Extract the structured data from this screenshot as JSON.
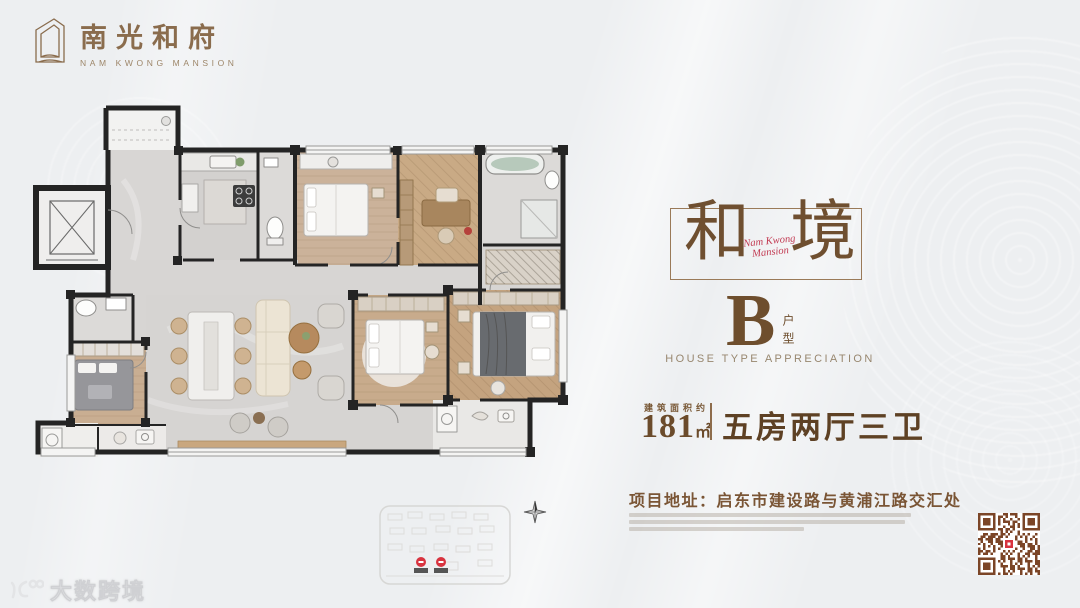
{
  "brand": {
    "name_cn": "南光和府",
    "name_en": "NAM KWONG MANSION"
  },
  "hero": {
    "frame_char_left": "和",
    "frame_char_right": "境",
    "script_line1": "Nam Kwong",
    "script_line2": "Mansion",
    "type_letter": "B",
    "type_label": "户型",
    "type_subtitle": "HOUSE TYPE APPRECIATION",
    "area_label": "建筑面积约",
    "area_value": "181",
    "area_unit": "㎡",
    "layout_text": "五房两厅三卫",
    "address_label": "项目地址：",
    "address_value": "启东市建设路与黄浦江路交汇处"
  },
  "watermark": {
    "text": "大数跨境"
  },
  "floorplan": {
    "type": "residential-floor-plan",
    "rooms": [
      "elevator",
      "entry-foyer",
      "kitchen",
      "bathroom-1",
      "bedroom-2",
      "study",
      "bathroom-2",
      "bathroom-3",
      "bedroom-3",
      "living-dining",
      "bedroom-4",
      "master-bedroom",
      "balcony-left",
      "balcony-right"
    ]
  },
  "colors": {
    "background": "#edeff1",
    "accent_brown": "#7a5a38",
    "deep_brown": "#6b4b2b",
    "script_red": "#c23a52",
    "wall_black": "#242424",
    "qr_brown": "#7b4527",
    "pin_red": "#d8333f"
  }
}
